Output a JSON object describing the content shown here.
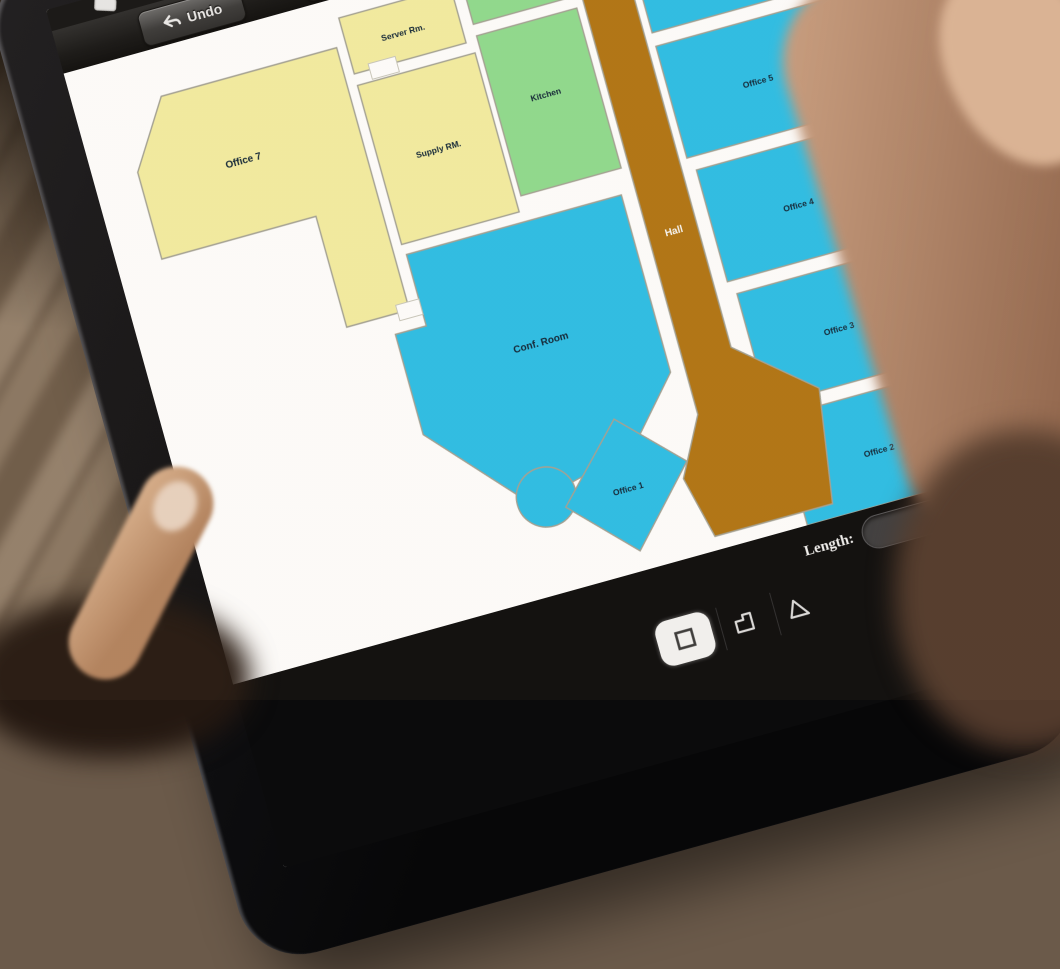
{
  "toolbar": {
    "undo_label": "Undo"
  },
  "length_panel": {
    "label": "Length:",
    "value": ""
  },
  "icons": {
    "undo": "undo-arrow-icon",
    "tools": "crossed-tools-icon",
    "move": "move-arrows-icon",
    "rect_tool": "rectangle-tool-icon",
    "poly_tool": "polygon-tool-icon",
    "tri_tool": "triangle-tool-icon"
  },
  "floor_plan": {
    "wall_color": "#ffffff",
    "rooms": [
      {
        "id": "office-7",
        "label": "Office 7",
        "color": "#f4eea2"
      },
      {
        "id": "server-room",
        "label": "Server Rm.",
        "color": "#f4eea2"
      },
      {
        "id": "supply-room",
        "label": "Supply RM.",
        "color": "#f4eea2"
      },
      {
        "id": "rest-room",
        "label": "Rest. Room",
        "color": "#8fdc8f"
      },
      {
        "id": "kitchen",
        "label": "Kitchen",
        "color": "#8fdc8f"
      },
      {
        "id": "office-5",
        "label": "Office 5",
        "color": "#2bbfe8"
      },
      {
        "id": "office-4",
        "label": "Office 4",
        "color": "#2bbfe8"
      },
      {
        "id": "office-3",
        "label": "Office 3",
        "color": "#2bbfe8"
      },
      {
        "id": "office-2",
        "label": "Office 2",
        "color": "#2bbfe8"
      },
      {
        "id": "office-1",
        "label": "Office 1",
        "color": "#2bbfe8"
      },
      {
        "id": "conf-room",
        "label": "Conf. Room",
        "color": "#2bbfe8"
      },
      {
        "id": "hall",
        "label": "Hall",
        "color": "#b17513"
      },
      {
        "id": "unlabeled-room",
        "label": "",
        "color": "#2bbfe8"
      }
    ]
  }
}
